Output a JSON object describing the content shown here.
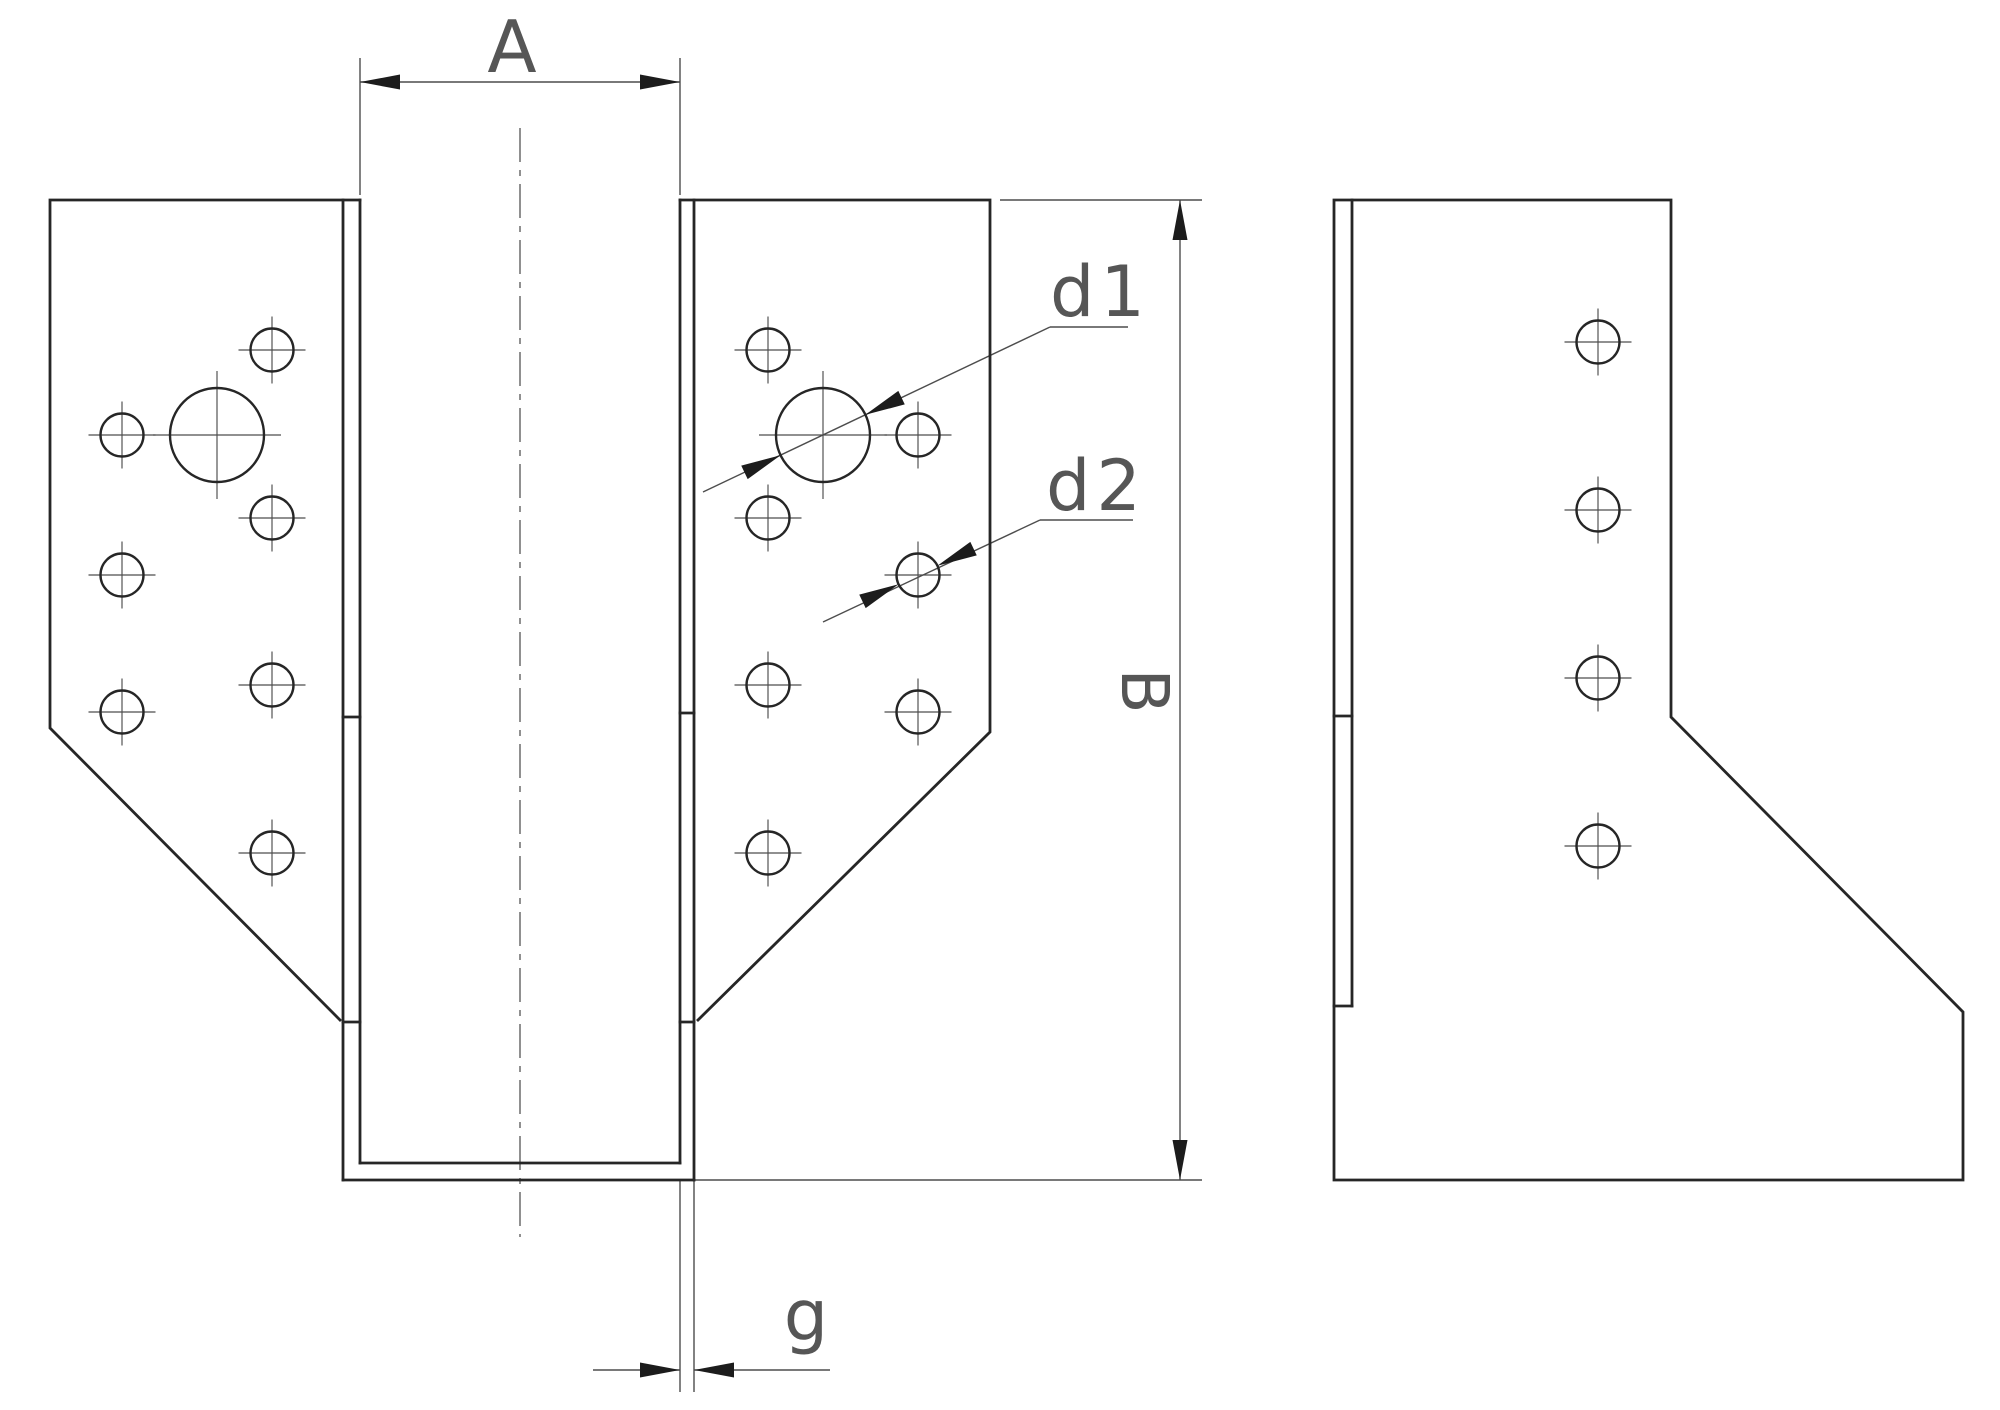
{
  "drawing": {
    "canvas": {
      "width": 2000,
      "height": 1410,
      "background": "#ffffff"
    },
    "colors": {
      "object_line": "#262626",
      "thin_line": "#4d4d4d",
      "centerline": "#555555",
      "crosshair": "#4d4d4d",
      "arrow": "#1c1c1c",
      "text": "#565656"
    },
    "labels": {
      "opening_width": "A",
      "height": "B",
      "large_hole_diameter": "d1",
      "small_hole_diameter": "d2",
      "material_thickness": "g"
    },
    "object_polylines": [
      {
        "name": "front-left-flange-outline",
        "pts": [
          [
            360,
            200
          ],
          [
            50,
            200
          ],
          [
            50,
            728
          ],
          [
            340,
            1020
          ]
        ]
      },
      {
        "name": "front-left-wall-outer-line",
        "pts": [
          [
            343,
            200
          ],
          [
            343,
            1180
          ]
        ]
      },
      {
        "name": "front-left-wall-inner-line",
        "pts": [
          [
            360,
            200
          ],
          [
            360,
            1163
          ]
        ]
      },
      {
        "name": "front-left-wall-break-tick-upper",
        "pts": [
          [
            343,
            717
          ],
          [
            360,
            717
          ]
        ]
      },
      {
        "name": "front-left-wall-break-tick-lower",
        "pts": [
          [
            343,
            1022
          ],
          [
            360,
            1022
          ]
        ]
      },
      {
        "name": "front-seat-bottom-inner-line",
        "pts": [
          [
            360,
            1163
          ],
          [
            680,
            1163
          ]
        ]
      },
      {
        "name": "front-seat-bottom-outer-line",
        "pts": [
          [
            343,
            1180
          ],
          [
            694,
            1180
          ]
        ]
      },
      {
        "name": "front-right-flange-outline",
        "pts": [
          [
            680,
            200
          ],
          [
            990,
            200
          ],
          [
            990,
            732
          ],
          [
            698,
            1020
          ]
        ]
      },
      {
        "name": "front-right-wall-inner-line",
        "pts": [
          [
            680,
            200
          ],
          [
            680,
            1163
          ]
        ]
      },
      {
        "name": "front-right-wall-outer-line",
        "pts": [
          [
            694,
            200
          ],
          [
            694,
            1180
          ]
        ]
      },
      {
        "name": "front-right-wall-break-tick-upper",
        "pts": [
          [
            680,
            713
          ],
          [
            694,
            713
          ]
        ]
      },
      {
        "name": "front-right-wall-break-tick-lower",
        "pts": [
          [
            680,
            1022
          ],
          [
            694,
            1022
          ]
        ]
      },
      {
        "name": "side-view-outline",
        "pts": [
          [
            1334,
            200
          ],
          [
            1671,
            200
          ],
          [
            1671,
            717
          ],
          [
            1963,
            1012
          ],
          [
            1963,
            1180
          ],
          [
            1334,
            1180
          ],
          [
            1334,
            200
          ]
        ]
      },
      {
        "name": "side-back-plate-inner-line",
        "pts": [
          [
            1352,
            200
          ],
          [
            1352,
            1006
          ]
        ]
      },
      {
        "name": "side-break-tick-upper",
        "pts": [
          [
            1334,
            716
          ],
          [
            1352,
            716
          ]
        ]
      },
      {
        "name": "side-break-tick-lower",
        "pts": [
          [
            1334,
            1006
          ],
          [
            1352,
            1006
          ]
        ]
      }
    ],
    "thin_polylines": [
      {
        "name": "dim-a-extension-left",
        "pts": [
          [
            360,
            58
          ],
          [
            360,
            195
          ]
        ]
      },
      {
        "name": "dim-a-extension-right",
        "pts": [
          [
            680,
            58
          ],
          [
            680,
            195
          ]
        ]
      },
      {
        "name": "dim-a-line",
        "pts": [
          [
            360,
            82
          ],
          [
            680,
            82
          ]
        ]
      },
      {
        "name": "dim-b-extension-top",
        "pts": [
          [
            1000,
            200
          ],
          [
            1202,
            200
          ]
        ]
      },
      {
        "name": "dim-b-extension-bottom",
        "pts": [
          [
            694,
            1180
          ],
          [
            1202,
            1180
          ]
        ]
      },
      {
        "name": "dim-b-line",
        "pts": [
          [
            1180,
            200
          ],
          [
            1180,
            1180
          ]
        ]
      },
      {
        "name": "dim-g-extension-left",
        "pts": [
          [
            680,
            1180
          ],
          [
            680,
            1392
          ]
        ]
      },
      {
        "name": "dim-g-extension-right",
        "pts": [
          [
            694,
            1180
          ],
          [
            694,
            1392
          ]
        ]
      },
      {
        "name": "dim-g-line-left-tail",
        "pts": [
          [
            593,
            1370
          ],
          [
            680,
            1370
          ]
        ]
      },
      {
        "name": "dim-g-line-right-tail",
        "pts": [
          [
            694,
            1370
          ],
          [
            830,
            1370
          ]
        ]
      },
      {
        "name": "dim-d1-leader",
        "pts": [
          [
            703,
            492
          ],
          [
            1050,
            327
          ]
        ]
      },
      {
        "name": "dim-d1-underline",
        "pts": [
          [
            1050,
            327
          ],
          [
            1128,
            327
          ]
        ]
      },
      {
        "name": "dim-d2-leader",
        "pts": [
          [
            823,
            622
          ],
          [
            1040,
            520
          ]
        ]
      },
      {
        "name": "dim-d2-underline",
        "pts": [
          [
            1040,
            520
          ],
          [
            1133,
            520
          ]
        ]
      }
    ],
    "centerlines": [
      {
        "name": "beam-vertical-centerline",
        "pts": [
          [
            520,
            128
          ],
          [
            520,
            1237
          ]
        ]
      }
    ],
    "holes": [
      {
        "name": "nail-hole",
        "view": "front-left-flange",
        "cx": 272,
        "cy": 350,
        "r": 21.5
      },
      {
        "name": "nail-hole",
        "view": "front-left-flange",
        "cx": 122,
        "cy": 435,
        "r": 21.5
      },
      {
        "name": "bolt-hole-d1",
        "view": "front-left-flange",
        "cx": 217,
        "cy": 435,
        "r": 47
      },
      {
        "name": "nail-hole",
        "view": "front-left-flange",
        "cx": 272,
        "cy": 518,
        "r": 21.5
      },
      {
        "name": "nail-hole",
        "view": "front-left-flange",
        "cx": 122,
        "cy": 575,
        "r": 21.5
      },
      {
        "name": "nail-hole",
        "view": "front-left-flange",
        "cx": 272,
        "cy": 685,
        "r": 21.5
      },
      {
        "name": "nail-hole",
        "view": "front-left-flange",
        "cx": 122,
        "cy": 712,
        "r": 21.5
      },
      {
        "name": "nail-hole",
        "view": "front-left-flange",
        "cx": 272,
        "cy": 853,
        "r": 21.5
      },
      {
        "name": "nail-hole",
        "view": "front-right-flange",
        "cx": 768,
        "cy": 350,
        "r": 21.5
      },
      {
        "name": "nail-hole",
        "view": "front-right-flange",
        "cx": 918,
        "cy": 435,
        "r": 21.5
      },
      {
        "name": "bolt-hole-d1",
        "view": "front-right-flange",
        "cx": 823,
        "cy": 435,
        "r": 47
      },
      {
        "name": "nail-hole",
        "view": "front-right-flange",
        "cx": 768,
        "cy": 518,
        "r": 21.5
      },
      {
        "name": "nail-hole-d2",
        "view": "front-right-flange",
        "cx": 918,
        "cy": 575,
        "r": 21.5
      },
      {
        "name": "nail-hole",
        "view": "front-right-flange",
        "cx": 768,
        "cy": 685,
        "r": 21.5
      },
      {
        "name": "nail-hole",
        "view": "front-right-flange",
        "cx": 918,
        "cy": 712,
        "r": 21.5
      },
      {
        "name": "nail-hole",
        "view": "front-right-flange",
        "cx": 768,
        "cy": 853,
        "r": 21.5
      },
      {
        "name": "nail-hole",
        "view": "side-view",
        "cx": 1598,
        "cy": 342,
        "r": 21.5
      },
      {
        "name": "nail-hole",
        "view": "side-view",
        "cx": 1598,
        "cy": 510,
        "r": 21.5
      },
      {
        "name": "nail-hole",
        "view": "side-view",
        "cx": 1598,
        "cy": 678,
        "r": 21.5
      },
      {
        "name": "nail-hole",
        "view": "side-view",
        "cx": 1598,
        "cy": 846,
        "r": 21.5
      }
    ],
    "arrows": [
      {
        "name": "arrow-a-left",
        "x": 360,
        "y": 82,
        "angle": 180
      },
      {
        "name": "arrow-a-right",
        "x": 680,
        "y": 82,
        "angle": 0
      },
      {
        "name": "arrow-b-top",
        "x": 1180,
        "y": 200,
        "angle": 270
      },
      {
        "name": "arrow-b-bottom",
        "x": 1180,
        "y": 1180,
        "angle": 90
      },
      {
        "name": "arrow-g-left",
        "x": 680,
        "y": 1370,
        "angle": 0
      },
      {
        "name": "arrow-g-right",
        "x": 694,
        "y": 1370,
        "angle": 180
      },
      {
        "name": "arrow-d1-upper",
        "x": 865.4,
        "y": 414.8,
        "angle": 154.6
      },
      {
        "name": "arrow-d1-lower",
        "x": 780.6,
        "y": 455.2,
        "angle": -25.4
      },
      {
        "name": "arrow-d2-upper",
        "x": 937.4,
        "y": 565.8,
        "angle": 154.6
      },
      {
        "name": "arrow-d2-lower",
        "x": 898.6,
        "y": 584.2,
        "angle": -25.4
      }
    ],
    "texts": [
      {
        "name": "dim-label-a",
        "s": "A",
        "x": 512,
        "y": 72,
        "size": 72,
        "anchor": "middle",
        "rotate": 0,
        "ls": 0
      },
      {
        "name": "dim-label-b",
        "s": "B",
        "x": 1122,
        "y": 691,
        "size": 66,
        "anchor": "middle",
        "rotate": 90,
        "ls": 0
      },
      {
        "name": "dim-label-d1",
        "s": "d1",
        "x": 1050,
        "y": 316,
        "size": 70,
        "anchor": "start",
        "rotate": 0,
        "ls": 6
      },
      {
        "name": "dim-label-d2",
        "s": "d2",
        "x": 1046,
        "y": 510,
        "size": 70,
        "anchor": "start",
        "rotate": 0,
        "ls": 6
      },
      {
        "name": "dim-label-g",
        "s": "g",
        "x": 806,
        "y": 1340,
        "size": 70,
        "anchor": "middle",
        "rotate": 0,
        "ls": 0
      }
    ],
    "style": {
      "object_stroke_width": 2.8,
      "thin_stroke_width": 1.4,
      "centerline_stroke_width": 1.3,
      "centerline_dash": "34 8 6 8",
      "hole_stroke_width": 2.4,
      "crosshair_stroke_width": 1.15,
      "crosshair_overshoot_small": 12,
      "crosshair_overshoot_large": 17,
      "arrow_length": 40,
      "arrow_half_width": 7.5
    }
  }
}
